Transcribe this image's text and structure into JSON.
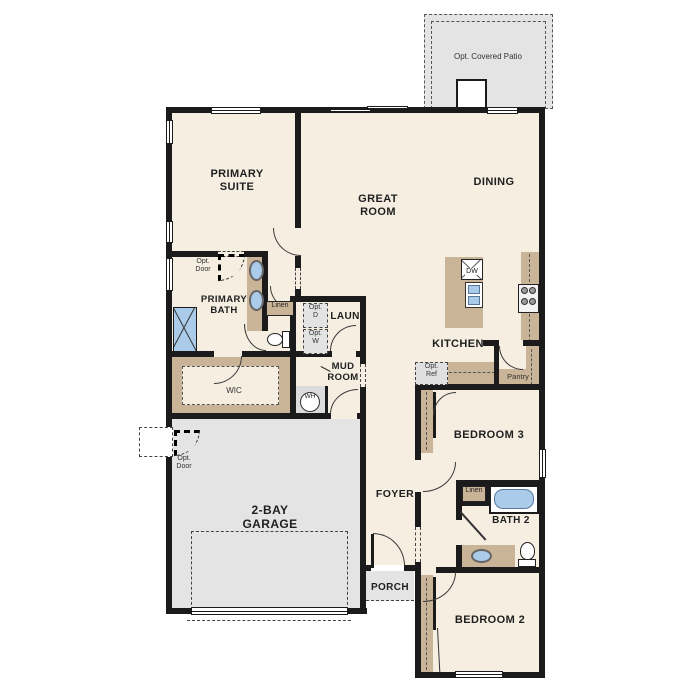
{
  "labels": {
    "patio": "Opt. Covered Patio",
    "primary_suite": "PRIMARY SUITE",
    "great_room": "GREAT ROOM",
    "dining": "DINING",
    "kitchen": "KITCHEN",
    "primary_bath": "PRIMARY BATH",
    "opt_door_suite": "Opt. Door",
    "opt_door_garage": "Opt. Door",
    "linen_primary": "Linen",
    "linen_bath2": "Linen",
    "opt_d": "Opt. D",
    "opt_w": "Opt. W",
    "laundry": "LAUN",
    "mud_room": "MUD ROOM",
    "wic": "WIC",
    "water_heater": "WH",
    "dishwasher": "DW",
    "opt_ref": "Opt. Ref",
    "pantry": "Pantry",
    "bedroom3": "BEDROOM 3",
    "bath2": "BATH 2",
    "foyer": "FOYER",
    "garage": "2-BAY GARAGE",
    "porch": "PORCH",
    "bedroom2": "BEDROOM 2"
  },
  "colors": {
    "wall": "#1b1b1b",
    "room_fill": "#f5eee1",
    "garage_fill": "#e4e4e4",
    "cabinet_tan": "#c9b497",
    "fixture_blue": "#aacbe9",
    "label_text": "#1f1f1f"
  }
}
